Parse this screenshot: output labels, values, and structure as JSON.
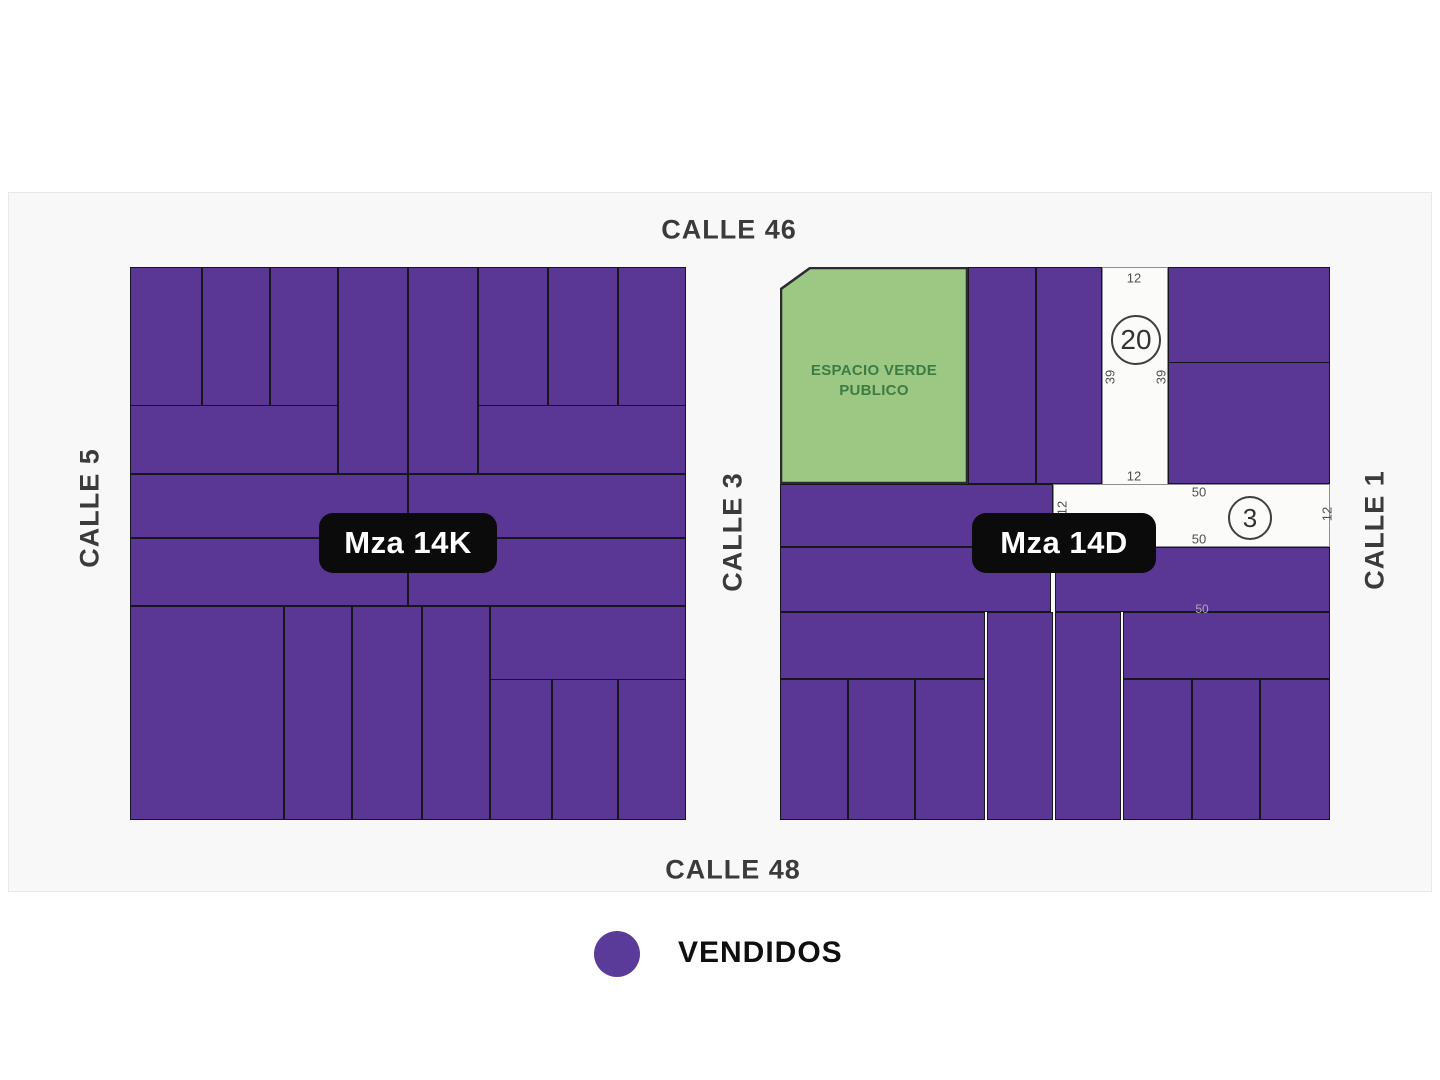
{
  "colors": {
    "sold_fill": "#5A3795",
    "lot_border": "#17151D",
    "green_fill": "#9CC884",
    "green_border": "#2B2B31",
    "green_text": "#3C7C42",
    "white_lot_fill": "#FBFBFA",
    "white_lot_border": "#8F8F8F",
    "dim_text": "#4F4F4F",
    "faint_dim_text": "#ABABAB",
    "circle_border": "#3F3F3F",
    "circle_text": "#333333",
    "street_text": "#3B3B3B",
    "pill_bg": "#0B0B0B",
    "pill_text": "#FFFFFF",
    "legend_dot": "#5B3B9A"
  },
  "streets": [
    {
      "id": "calle-46",
      "label": "CALLE 46",
      "x": 729,
      "y": 230,
      "rotated": false
    },
    {
      "id": "calle-48",
      "label": "CALLE 48",
      "x": 733,
      "y": 870,
      "rotated": false
    },
    {
      "id": "calle-5",
      "label": "CALLE 5",
      "x": 90,
      "y": 508,
      "rotated": true
    },
    {
      "id": "calle-3",
      "label": "CALLE 3",
      "x": 733,
      "y": 532,
      "rotated": true
    },
    {
      "id": "calle-1",
      "label": "CALLE 1",
      "x": 1375,
      "y": 530,
      "rotated": true
    }
  ],
  "block_pills": [
    {
      "id": "mza-14k",
      "label": "Mza 14K",
      "x": 408,
      "y": 543,
      "w": 178,
      "h": 60
    },
    {
      "id": "mza-14d",
      "label": "Mza 14D",
      "x": 1064,
      "y": 543,
      "w": 184,
      "h": 60
    }
  ],
  "green_lot": {
    "id": "espacio-verde-lot",
    "label_line1": "ESPACIO VERDE",
    "label_line2": "PUBLICO",
    "x": 780,
    "y": 267,
    "w": 188,
    "h": 217,
    "chamfer_x": 30,
    "chamfer_y": 22,
    "label_cx": 874,
    "label_cy": 381
  },
  "sold_lots_mza_14k": [
    [
      130,
      267,
      72,
      139
    ],
    [
      202,
      267,
      68,
      139
    ],
    [
      270,
      267,
      68,
      139
    ],
    [
      338,
      267,
      70,
      207
    ],
    [
      408,
      267,
      70,
      207
    ],
    [
      478,
      267,
      70,
      139
    ],
    [
      548,
      267,
      70,
      139
    ],
    [
      618,
      267,
      68,
      139
    ],
    [
      130,
      405,
      208,
      69
    ],
    [
      478,
      405,
      208,
      69
    ],
    [
      130,
      474,
      278,
      64
    ],
    [
      408,
      474,
      278,
      64
    ],
    [
      130,
      538,
      278,
      68
    ],
    [
      408,
      538,
      278,
      68
    ],
    [
      130,
      606,
      154,
      214
    ],
    [
      284,
      606,
      68,
      214
    ],
    [
      352,
      606,
      70,
      214
    ],
    [
      422,
      606,
      68,
      214
    ],
    [
      490,
      606,
      196,
      74
    ],
    [
      490,
      679,
      62,
      141
    ],
    [
      552,
      679,
      66,
      141
    ],
    [
      618,
      679,
      68,
      141
    ]
  ],
  "sold_lots_mza_14d": [
    [
      968,
      267,
      68,
      217
    ],
    [
      1036,
      267,
      66,
      217
    ],
    [
      1168,
      267,
      162,
      96
    ],
    [
      1168,
      362,
      162,
      122
    ],
    [
      780,
      484,
      273,
      63
    ],
    [
      780,
      547,
      271,
      65
    ],
    [
      1055,
      547,
      275,
      65
    ],
    [
      780,
      612,
      205,
      67
    ],
    [
      987,
      612,
      66,
      208
    ],
    [
      1055,
      612,
      66,
      208
    ],
    [
      1123,
      612,
      207,
      67
    ],
    [
      780,
      679,
      68,
      141
    ],
    [
      848,
      679,
      67,
      141
    ],
    [
      915,
      679,
      70,
      141
    ],
    [
      1123,
      679,
      69,
      141
    ],
    [
      1192,
      679,
      68,
      141
    ],
    [
      1260,
      679,
      70,
      141
    ]
  ],
  "open_lots": [
    {
      "id": "lot-20",
      "x": 1102,
      "y": 267,
      "w": 66,
      "h": 218,
      "number": "20",
      "circle": {
        "x": 1134,
        "y": 338,
        "d": 46,
        "font": 28
      },
      "dims": [
        {
          "text": "12",
          "x": 1134,
          "y": 278,
          "rot": false
        },
        {
          "text": "39",
          "x": 1110,
          "y": 377,
          "rot": true
        },
        {
          "text": "39",
          "x": 1161,
          "y": 377,
          "rot": true
        },
        {
          "text": "12",
          "x": 1134,
          "y": 476,
          "rot": false
        }
      ]
    },
    {
      "id": "lot-3",
      "x": 1053,
      "y": 484,
      "w": 277,
      "h": 63,
      "number": "3",
      "circle": {
        "x": 1248,
        "y": 516,
        "d": 40,
        "font": 26
      },
      "dims": [
        {
          "text": "50",
          "x": 1199,
          "y": 492,
          "rot": false
        },
        {
          "text": "50",
          "x": 1199,
          "y": 539,
          "rot": false
        },
        {
          "text": "12",
          "x": 1327,
          "y": 514,
          "rot": true
        },
        {
          "text": "12",
          "x": 1062,
          "y": 508,
          "rot": true
        }
      ]
    }
  ],
  "stray_dims": [
    {
      "text": "50",
      "x": 1202,
      "y": 609,
      "faint": true
    }
  ],
  "legend": {
    "label": "VENDIDOS"
  }
}
